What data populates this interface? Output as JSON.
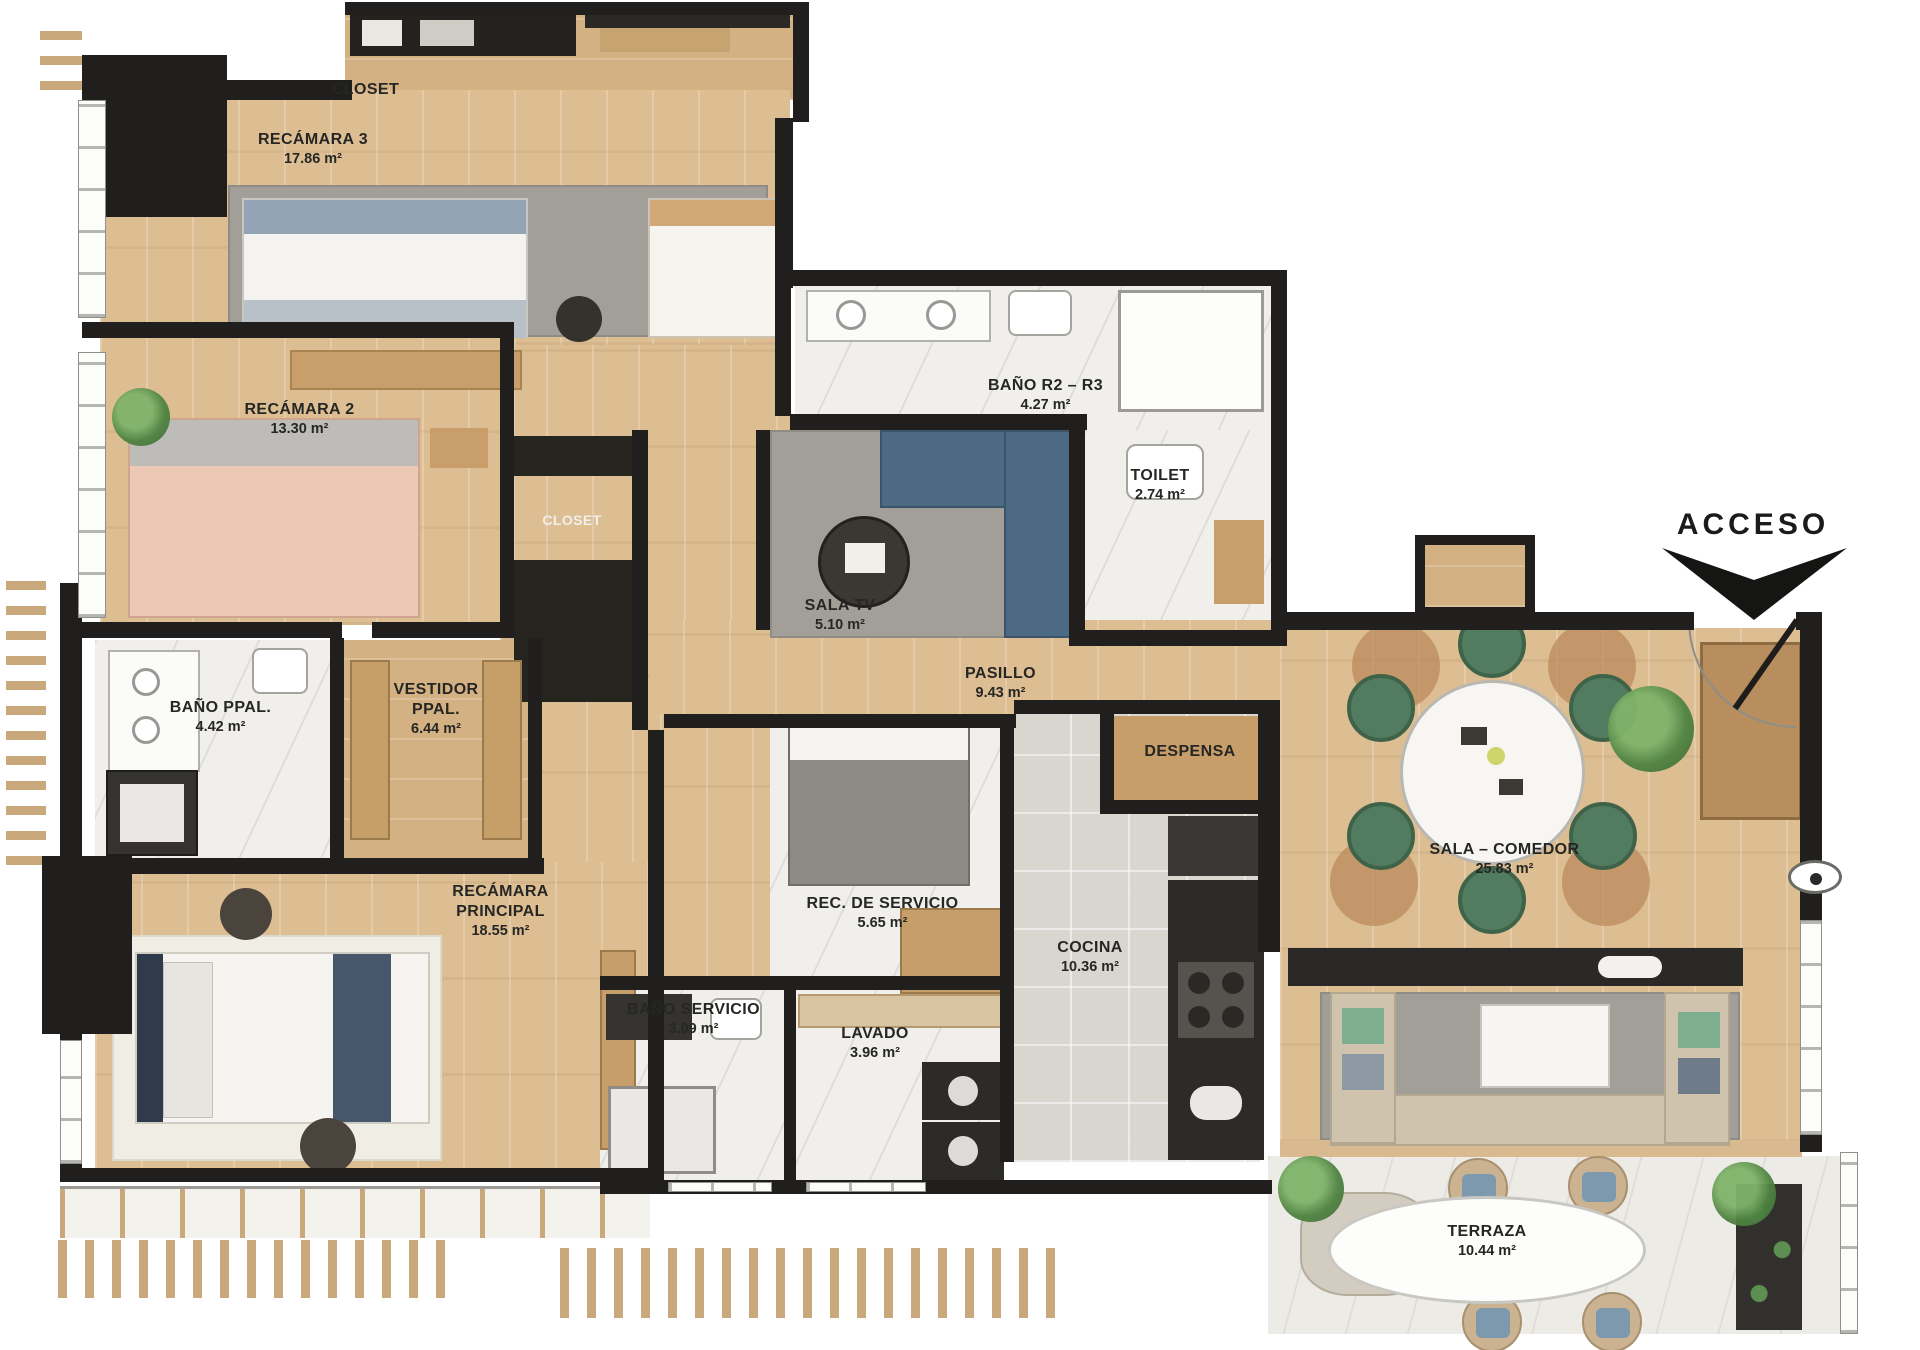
{
  "plan_title": "Planta arquitectónica",
  "acceso_label": "ACCESO",
  "rooms": {
    "closet_r3": {
      "name": "CLOSET"
    },
    "recamara3": {
      "name": "RECÁMARA 3",
      "area": "17.86 m²"
    },
    "recamara2": {
      "name": "RECÁMARA 2",
      "area": "13.30 m²"
    },
    "closet_r2": {
      "name": "CLOSET"
    },
    "bano_r2_r3": {
      "name": "BAÑO R2 – R3",
      "area": "4.27 m²"
    },
    "toilet": {
      "name": "TOILET",
      "area": "2.74 m²"
    },
    "sala_tv": {
      "name": "SALA TV",
      "area": "5.10 m²"
    },
    "pasillo": {
      "name": "PASILLO",
      "area": "9.43 m²"
    },
    "bano_ppal": {
      "name": "BAÑO PPAL.",
      "area": "4.42 m²"
    },
    "vestidor": {
      "name": "VESTIDOR PPAL.",
      "area": "6.44 m²"
    },
    "recamara_ppal": {
      "name": "RECÁMARA PRINCIPAL",
      "area": "18.55 m²"
    },
    "despensa": {
      "name": "DESPENSA"
    },
    "rec_servicio": {
      "name": "REC. DE SERVICIO",
      "area": "5.65 m²"
    },
    "cocina": {
      "name": "COCINA",
      "area": "10.36 m²"
    },
    "sala_comedor": {
      "name": "SALA – COMEDOR",
      "area": "25.83 m²"
    },
    "bano_servicio": {
      "name": "BAÑO SERVICIO",
      "area": "3.09 m²"
    },
    "lavado": {
      "name": "LAVADO",
      "area": "3.96 m²"
    },
    "terraza": {
      "name": "TERRAZA",
      "area": "10.44 m²"
    }
  },
  "palette": {
    "wall": "#201f1d",
    "wood_floor": "#ddbe93",
    "marble_floor": "#f0efec",
    "rug_gray": "#a19f98",
    "dining_chair_green": "#517c5f",
    "sofa_blue": "#4d6a85",
    "sofa_beige": "#cfc3ae",
    "label_text": "#262624"
  }
}
